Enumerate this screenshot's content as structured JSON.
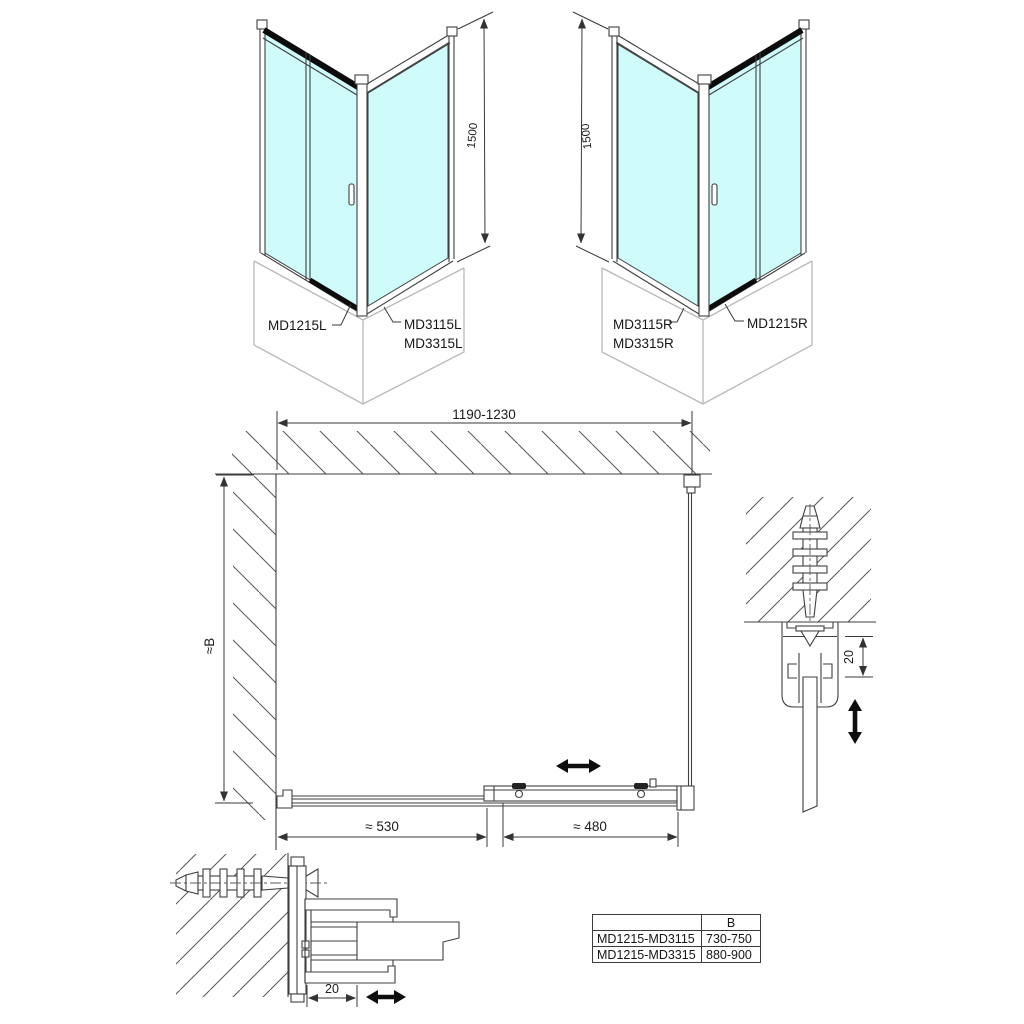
{
  "drawing": {
    "iso_left": {
      "door_label": "MD1215L",
      "side_label_1": "MD3115L",
      "side_label_2": "MD3315L",
      "height_dim": "1500"
    },
    "iso_right": {
      "side_label_1": "MD3115R",
      "side_label_2": "MD3315R",
      "door_label": "MD1215R",
      "height_dim": "1500"
    },
    "plan": {
      "width_dim": "1190-1230",
      "depth_dim": "≈B",
      "fixed_dim": "≈ 530",
      "slide_dim": "≈ 480"
    },
    "detail_right": {
      "adjust_dim": "20"
    },
    "detail_bottom_left": {
      "adjust_dim": "20"
    },
    "colors": {
      "glass": "#cffbfb",
      "dark": "#0c0c0c",
      "tray": "#b8b8b8"
    }
  },
  "table": {
    "header_b": "B",
    "rows": [
      {
        "models": "MD1215-MD3115",
        "b_range": "730-750"
      },
      {
        "models": "MD1215-MD3315",
        "b_range": "880-900"
      }
    ]
  }
}
